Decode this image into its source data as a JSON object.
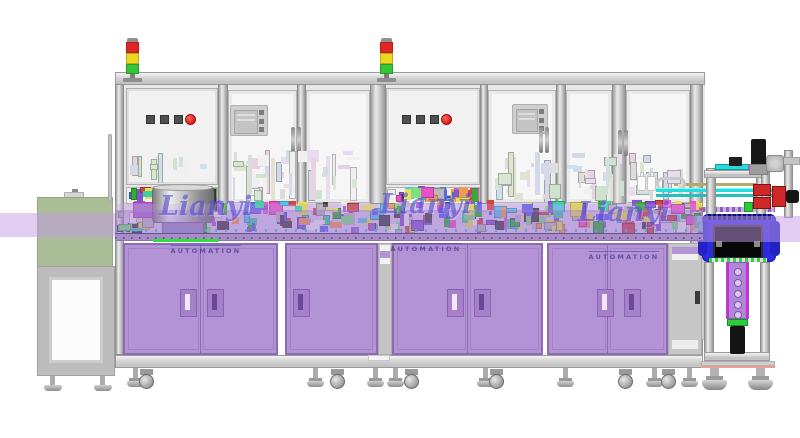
{
  "watermark": {
    "brand": "Lianyi",
    "sub": "AUTOMATION"
  },
  "colors": {
    "cabinet": "#b492d6",
    "cabinet_border": "#8d6bb0",
    "cabinet_handle": "#a780ca",
    "handle_slot_light": "#f3e6fc",
    "handle_slot_dark": "#6e4898",
    "band": "rgba(160,120,208,0.45)",
    "band_light": "rgba(196,156,228,0.5)",
    "table_bg": "#dacceb",
    "table_edge": "#a78cc8",
    "green_line": "#2de03c",
    "tunnel_green": "#a9bd96",
    "estop_red": "#e01818",
    "button_gray": "#4f4f4f",
    "blue_box": "#2a2ae0",
    "rail_cyan": "#2adada",
    "gear_red": "#cf2828",
    "bracket_purple": "#b185d8",
    "bracket_edge": "#e020e0",
    "stack_light": [
      "#e02525",
      "#ecd91f",
      "#35c435"
    ]
  },
  "palettes": {
    "vivid": [
      "#9b59d0",
      "#7de07d",
      "#52c6e8",
      "#e852c8",
      "#e8e04e",
      "#f09a52",
      "#5f5fe8",
      "#3ed0a2",
      "#d04444",
      "#b8b8b8",
      "#8452cc",
      "#2fae2f",
      "#ededed",
      "#404040"
    ],
    "pale": [
      "#d9e6d2",
      "#d2dae8",
      "#e6d2e0",
      "#e2e2d2",
      "#cfe0e6",
      "#dcdcdc",
      "#cfe2cc",
      "#e6dcee",
      "#f0f0f0"
    ]
  },
  "layout": {
    "columns": [
      {
        "x": 115,
        "w": 9,
        "h": 271
      },
      {
        "x": 218,
        "w": 10,
        "h": 120
      },
      {
        "x": 297,
        "w": 9,
        "h": 120
      },
      {
        "x": 370,
        "w": 16,
        "h": 120
      },
      {
        "x": 480,
        "w": 8,
        "h": 120
      },
      {
        "x": 556,
        "w": 10,
        "h": 120
      },
      {
        "x": 612,
        "w": 14,
        "h": 120
      },
      {
        "x": 690,
        "w": 13,
        "h": 271
      }
    ],
    "windows": [
      {
        "x": 126,
        "y": 88,
        "w": 92,
        "h": 97,
        "kind": "door"
      },
      {
        "x": 228,
        "y": 90,
        "w": 69,
        "h": 113,
        "kind": "window"
      },
      {
        "x": 306,
        "y": 90,
        "w": 64,
        "h": 113,
        "kind": "window"
      },
      {
        "x": 386,
        "y": 88,
        "w": 94,
        "h": 97,
        "kind": "door"
      },
      {
        "x": 488,
        "y": 90,
        "w": 68,
        "h": 113,
        "kind": "window"
      },
      {
        "x": 566,
        "y": 90,
        "w": 46,
        "h": 113,
        "kind": "window"
      },
      {
        "x": 626,
        "y": 90,
        "w": 64,
        "h": 113,
        "kind": "window"
      },
      {
        "x": 126,
        "y": 187,
        "w": 92,
        "h": 17,
        "kind": "lower"
      },
      {
        "x": 386,
        "y": 187,
        "w": 94,
        "h": 17,
        "kind": "lower"
      }
    ],
    "button_panels": [
      {
        "squares": [
          146,
          160,
          174
        ],
        "y": 115,
        "red": 185
      },
      {
        "squares": [
          402,
          416,
          430
        ],
        "y": 115,
        "red": 441
      }
    ],
    "hmi": [
      {
        "x": 230,
        "y": 105,
        "w": 38,
        "h": 31
      },
      {
        "x": 512,
        "y": 104,
        "w": 36,
        "h": 30
      }
    ],
    "door_handles": [
      {
        "x": 291,
        "y": 127
      },
      {
        "x": 539,
        "y": 127
      },
      {
        "x": 618,
        "y": 130
      }
    ],
    "stack_lights": [
      126,
      380
    ],
    "cabinets": [
      {
        "x": 123,
        "w": 155,
        "split": true,
        "handles": [
          {
            "x": 180,
            "light": true
          },
          {
            "x": 207,
            "light": false
          }
        ]
      },
      {
        "x": 285,
        "w": 93,
        "split": false,
        "handles": [
          {
            "x": 293,
            "light": false
          }
        ]
      },
      {
        "x": 392,
        "w": 151,
        "split": true,
        "handles": [
          {
            "x": 447,
            "light": true
          },
          {
            "x": 474,
            "light": false
          }
        ]
      },
      {
        "x": 547,
        "w": 121,
        "split": true,
        "handles": [
          {
            "x": 597,
            "light": true
          },
          {
            "x": 624,
            "light": false
          }
        ]
      }
    ],
    "feet": {
      "t": [
        127,
        307,
        367,
        387,
        477,
        557,
        646,
        681
      ],
      "casters": [
        139,
        330,
        404,
        489,
        618,
        661
      ],
      "left": [
        44,
        94
      ],
      "right_big": [
        702,
        748
      ]
    },
    "clutter_zones": [
      {
        "x": 115,
        "y": 200,
        "w": 588,
        "h": 33,
        "n": 260,
        "palette": "vivid"
      },
      {
        "x": 125,
        "y": 186,
        "w": 92,
        "h": 16,
        "n": 36,
        "palette": "vivid"
      },
      {
        "x": 387,
        "y": 186,
        "w": 92,
        "h": 16,
        "n": 36,
        "palette": "vivid"
      },
      {
        "x": 232,
        "y": 150,
        "w": 132,
        "h": 52,
        "n": 46,
        "palette": "pale",
        "tall": true
      },
      {
        "x": 492,
        "y": 150,
        "w": 160,
        "h": 52,
        "n": 42,
        "palette": "pale",
        "tall": true
      },
      {
        "x": 130,
        "y": 152,
        "w": 84,
        "h": 31,
        "n": 12,
        "palette": "pale",
        "tall": true
      },
      {
        "x": 570,
        "y": 165,
        "w": 40,
        "h": 37,
        "n": 10,
        "palette": "pale",
        "tall": true
      },
      {
        "x": 630,
        "y": 168,
        "w": 56,
        "h": 34,
        "n": 8,
        "palette": "pale",
        "tall": true
      }
    ]
  }
}
